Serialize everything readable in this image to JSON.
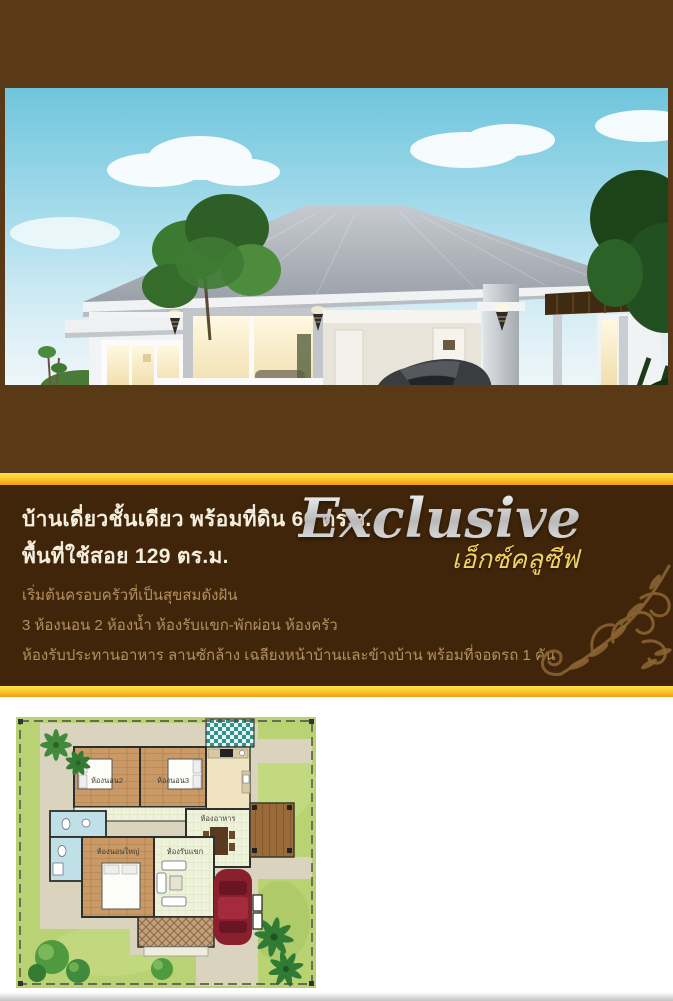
{
  "photo": {
    "caption": "ภาพบ้านและบรรยากาศจำลอง"
  },
  "specs": {
    "title_line1": "บ้านเดี่ยวชั้นเดียว พร้อมที่ดิน 60 ตร.ว.",
    "title_line2": "พื้นที่ใช้สอย 129 ตร.ม.",
    "tagline": "เริ่มต้นครอบครัวที่เป็นสุขสมดังฝัน",
    "features": [
      "3 ห้องนอน 2 ห้องน้ำ ห้องรับแขก-พักผ่อน ห้องครัว",
      "ห้องรับประทานอาหาร ลานซักล้าง เฉลียงหน้าบ้านและข้างบ้าน พร้อมที่จอดรถ 1 คัน"
    ]
  },
  "brand": {
    "name_en": "Exclusive",
    "name_th": "เอ็กซ์คลูซีฟ"
  },
  "floorplan": {
    "rooms": {
      "bedroom2": "ห้องนอน2",
      "bedroom3": "ห้องนอน3",
      "dining": "ห้องอาหาร",
      "master_bedroom": "ห้องนอนใหญ่",
      "living": "ห้องรับแขก"
    }
  },
  "colors": {
    "brown_medium": "#5a3a16",
    "brown_dark": "#40250a",
    "gold_light": "#ffe049",
    "gold_dark": "#f29a16",
    "heading_text": "#f4eedf",
    "body_text": "#b3905e",
    "brand_silver": "#e9e9e9",
    "brand_gold": "#f0d264",
    "flourish": "#8a6332",
    "plan_lawn": "#b9d273",
    "plan_car": "#8a1f2e"
  }
}
